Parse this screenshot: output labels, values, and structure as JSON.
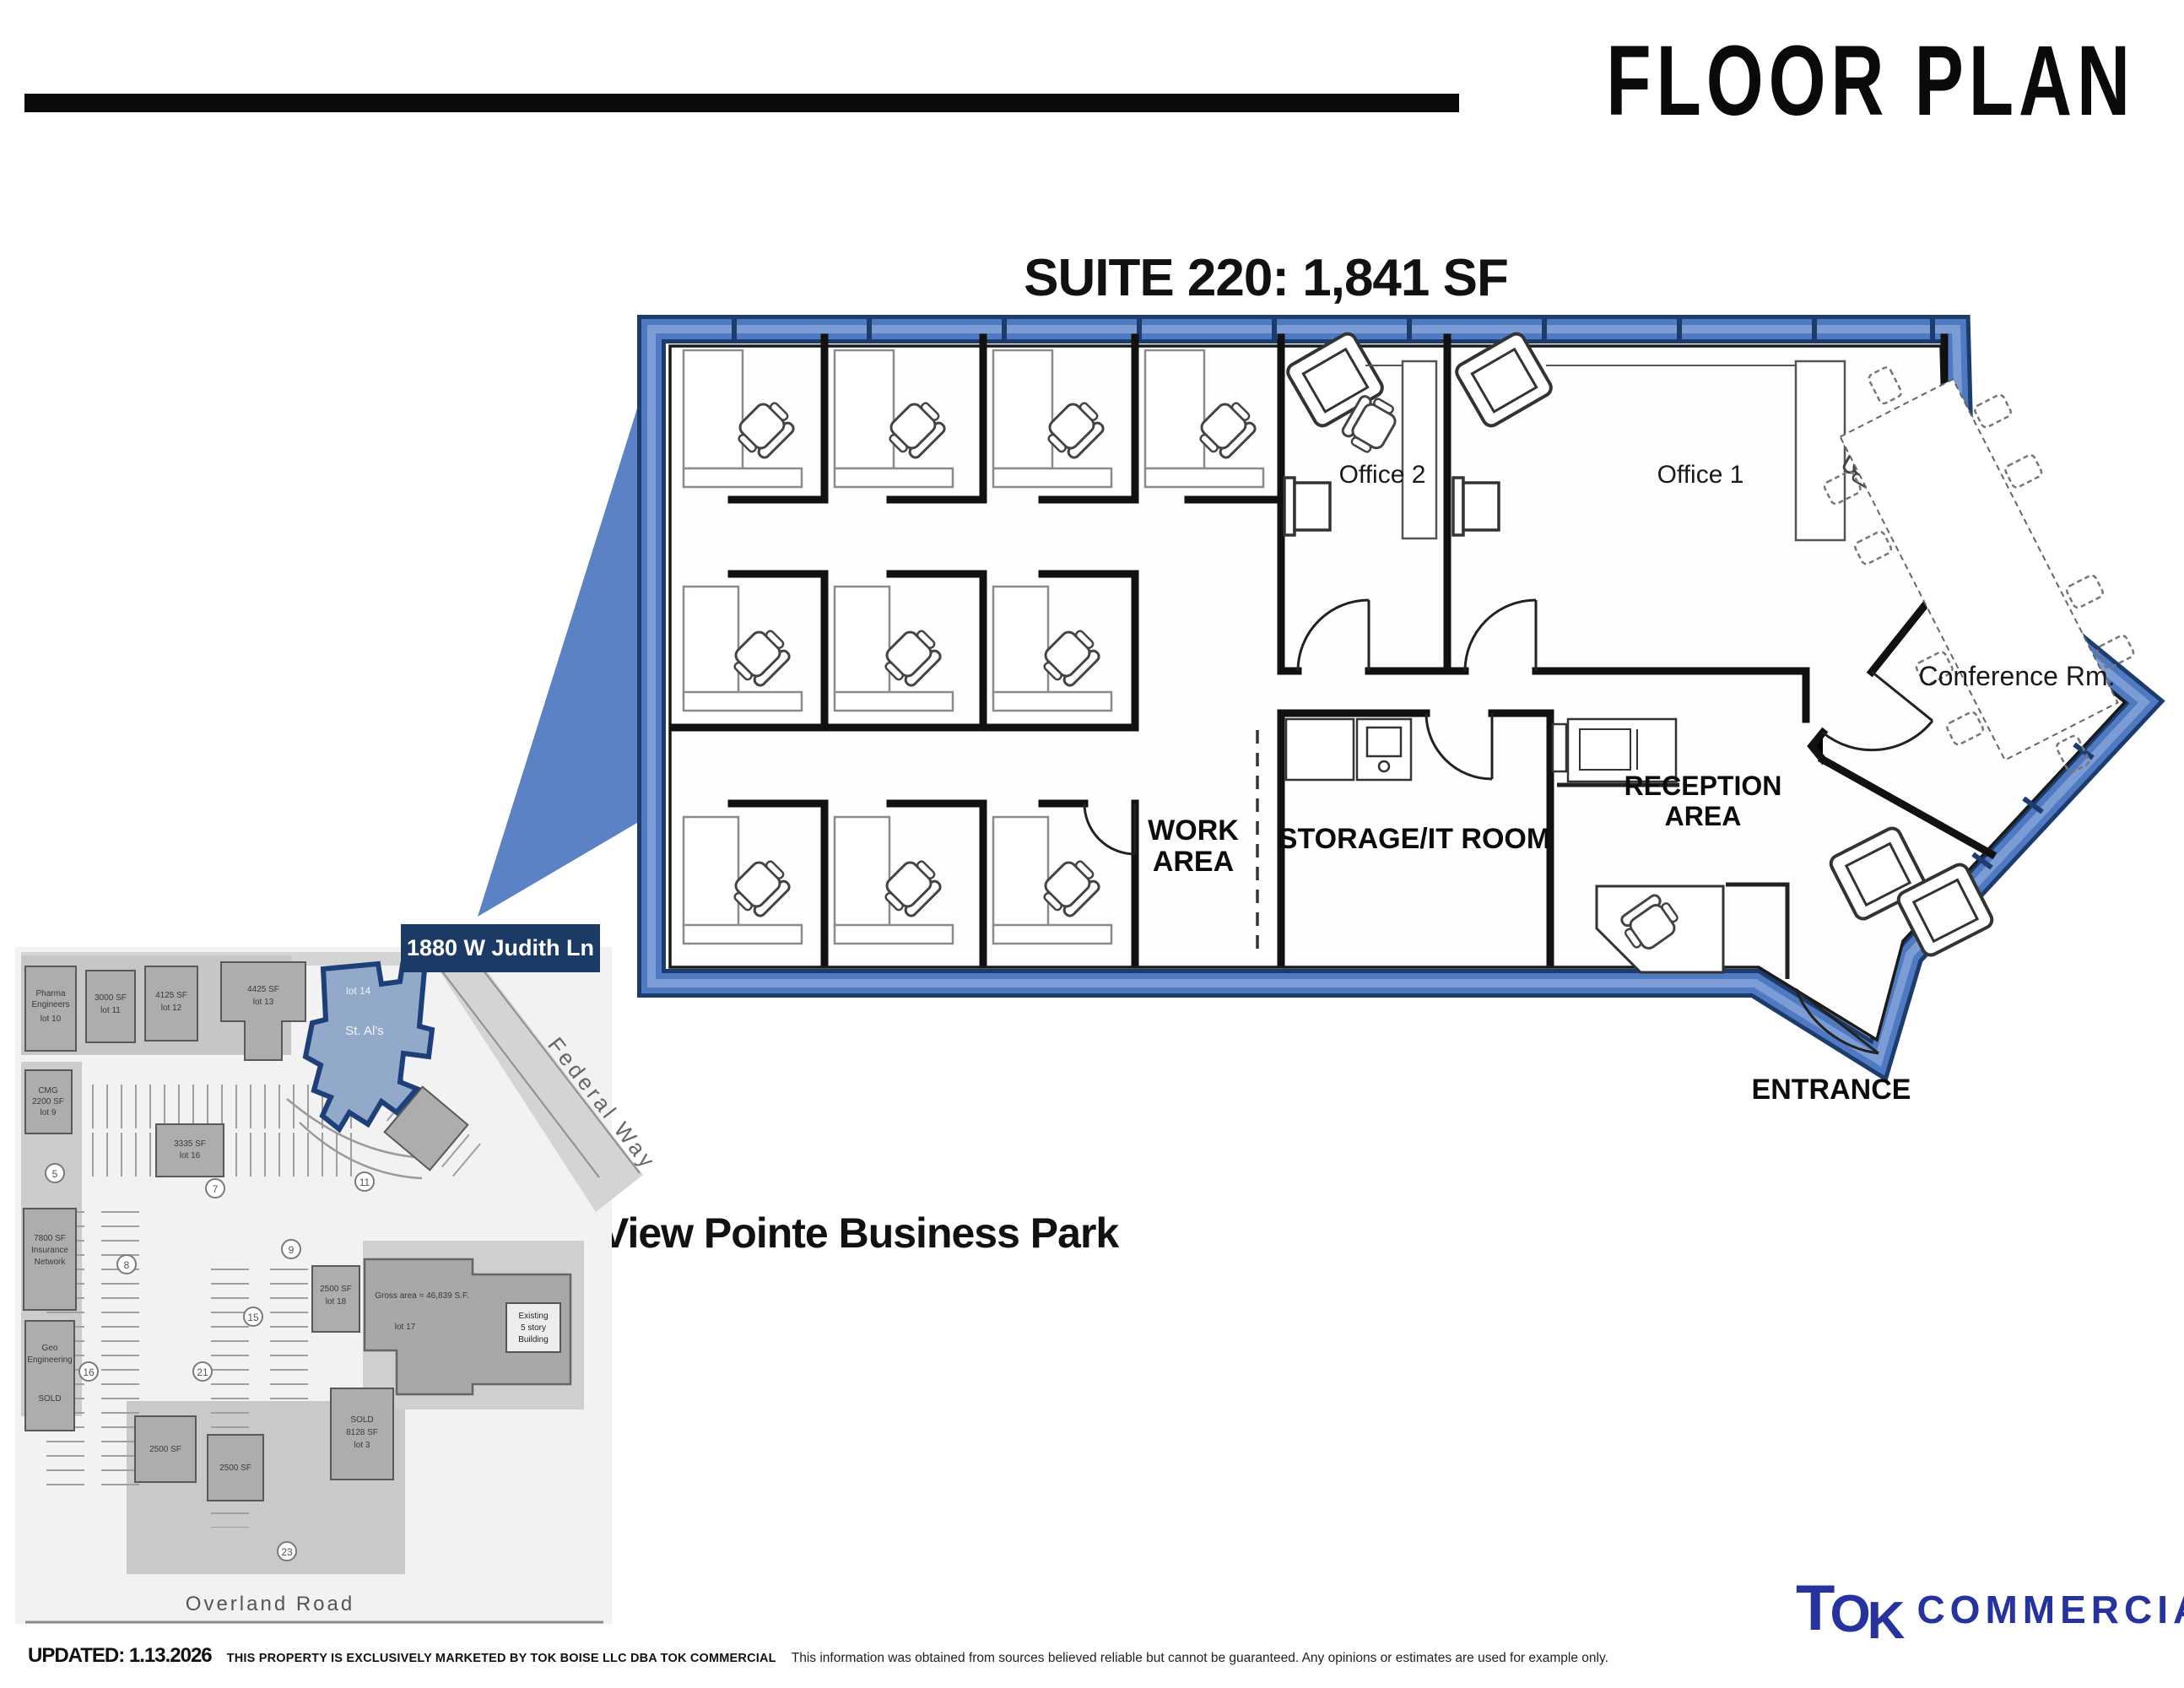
{
  "header": {
    "title": "FLOOR PLAN"
  },
  "suite": {
    "title": "SUITE 220: 1,841 SF"
  },
  "floor_plan": {
    "labels": {
      "office2": "Office 2",
      "office1": "Office 1",
      "conference": "Conference Rm.",
      "work_line1": "WORK",
      "work_line2": "AREA",
      "storage": "STORAGE/IT ROOM",
      "reception_line1": "RECEPTION",
      "reception_line2": "AREA",
      "entrance": "ENTRANCE"
    },
    "colors": {
      "border_navy": "#1d3c6e",
      "border_blue": "#4f79c0",
      "border_light": "#7b9cd4",
      "wedge": "#5b82c4"
    }
  },
  "site_plan": {
    "address_banner": "1880 W Judith Ln",
    "federal_way": "Federal Way",
    "overland_road": "Overland Road",
    "park_name": "View Pointe Business Park",
    "parcel": {
      "line1": "lot 14",
      "line2": "St. Al's"
    },
    "blocks": {
      "b1a": "Pharma",
      "b1b": "Engineers",
      "b1c": "lot 10",
      "b2a": "3000 SF",
      "b2b": "lot 11",
      "b3a": "4125 SF",
      "b3b": "lot 12",
      "b4a": "4425 SF",
      "b4b": "lot 13",
      "b5a": "CMG",
      "b5b": "2200 SF",
      "b5c": "lot 9",
      "b6a": "3335 SF",
      "b6b": "lot 16",
      "b7a": "7800 SF",
      "b7b": "Insurance",
      "b7c": "Network",
      "b8a": "Geo",
      "b8b": "Engineering",
      "b8c": "SOLD",
      "b9a": "2500 SF",
      "b9b": "lot 18",
      "b10a": "2500 SF",
      "b11a": "2500 SF",
      "b12a": "SOLD",
      "b12b": "8128 SF",
      "b12c": "lot 3",
      "b13a": "Gross area = 46,839 S.F.",
      "b13b": "lot 17",
      "b13c": "Existing",
      "b13d": "5 story",
      "b13e": "Building"
    },
    "markers": [
      "5",
      "7",
      "8",
      "9",
      "11",
      "15",
      "16",
      "21",
      "23"
    ]
  },
  "footer": {
    "updated": "UPDATED:  1.13.2026",
    "marketing": "THIS PROPERTY IS EXCLUSIVELY MARKETED BY TOK BOISE LLC DBA TOK COMMERCIAL",
    "disclaimer": "This information was obtained from sources believed reliable but cannot be guaranteed. Any opinions or estimates are used for example only.",
    "logo": {
      "t": "T",
      "o": "O",
      "k": "K",
      "rest": "COMMERCIAL.COM"
    }
  }
}
